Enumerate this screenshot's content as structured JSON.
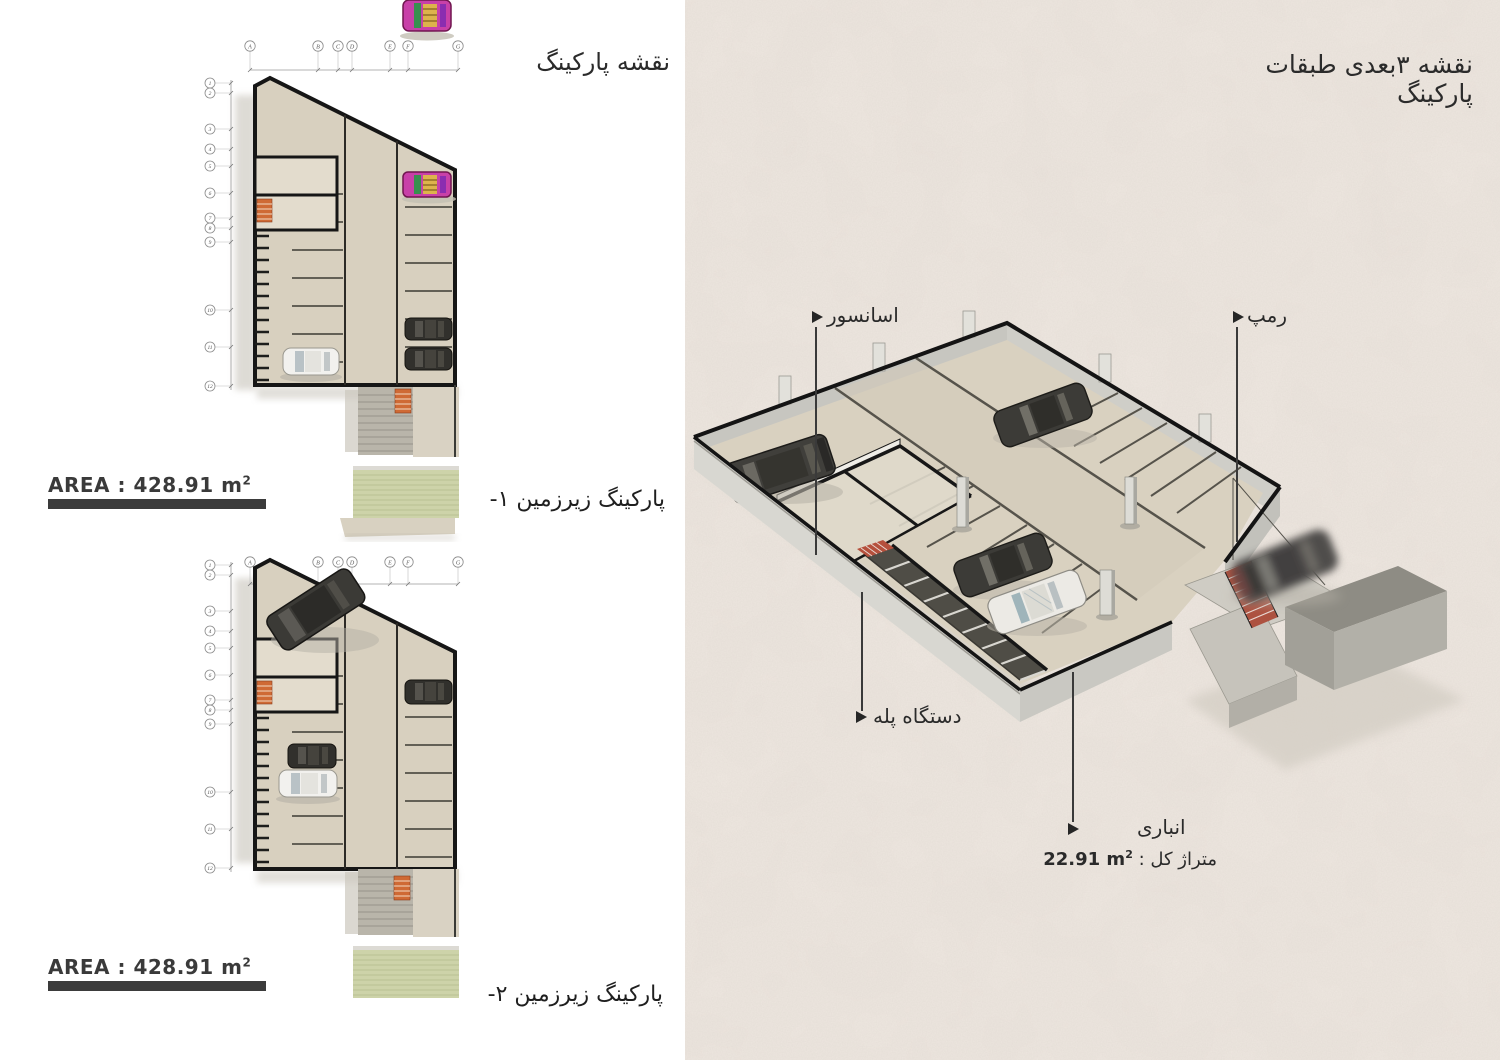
{
  "page": {
    "left_title": "نقشه پارکینگ",
    "right_title": "نقشه ۳بعدی طبقات پارکینگ"
  },
  "plans": [
    {
      "caption": "پارکینگ زیرزمین ۱-",
      "area_label": "AREA : 428.91 m",
      "area_exponent": "2"
    },
    {
      "caption": "پارکینگ زیرزمین ۲-",
      "area_label": "AREA : 428.91 m",
      "area_exponent": "2"
    }
  ],
  "grid": {
    "columns": [
      "A",
      "B",
      "C",
      "D",
      "E",
      "F",
      "G"
    ],
    "rows": [
      "1",
      "2",
      "3",
      "4",
      "5",
      "6",
      "7",
      "8",
      "9",
      "10",
      "11",
      "12"
    ]
  },
  "annotations": {
    "elevator": "اسانسور",
    "ramp": "رمپ",
    "stairs": "دستگاه پله",
    "storage": "انباری",
    "total_area_label": "متراژ کل :",
    "total_area_value": "22.91 m",
    "total_area_exponent": "2"
  },
  "colors": {
    "paper": "#efe8e1",
    "floor": "#d9d1c0",
    "wall_light": "#d8d7d1",
    "outline": "#161616",
    "stair_orange": "#cf6a35",
    "ramp_red": "#ad5240",
    "grass_green": "#cdd3a9",
    "area_bar": "#3b3b3b"
  }
}
